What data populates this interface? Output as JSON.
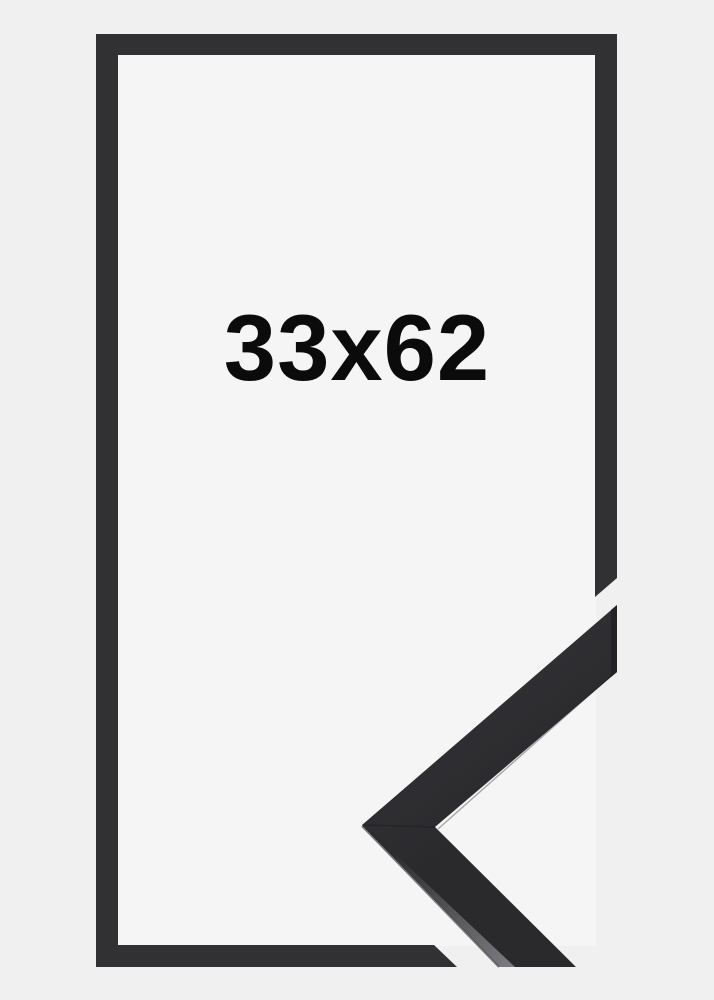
{
  "product": {
    "size_label": "33x62"
  },
  "colors": {
    "background": "#f0f0f1",
    "inner_background": "#f5f5f6",
    "outline": "#313134",
    "frame_face": "#2a2a2d",
    "frame_face_light": "#323236",
    "frame_edge_highlight": "#7a7a80",
    "frame_end_shadow": "#232327",
    "frame_seam": "#1e1e21",
    "text": "#0b0b0c"
  }
}
